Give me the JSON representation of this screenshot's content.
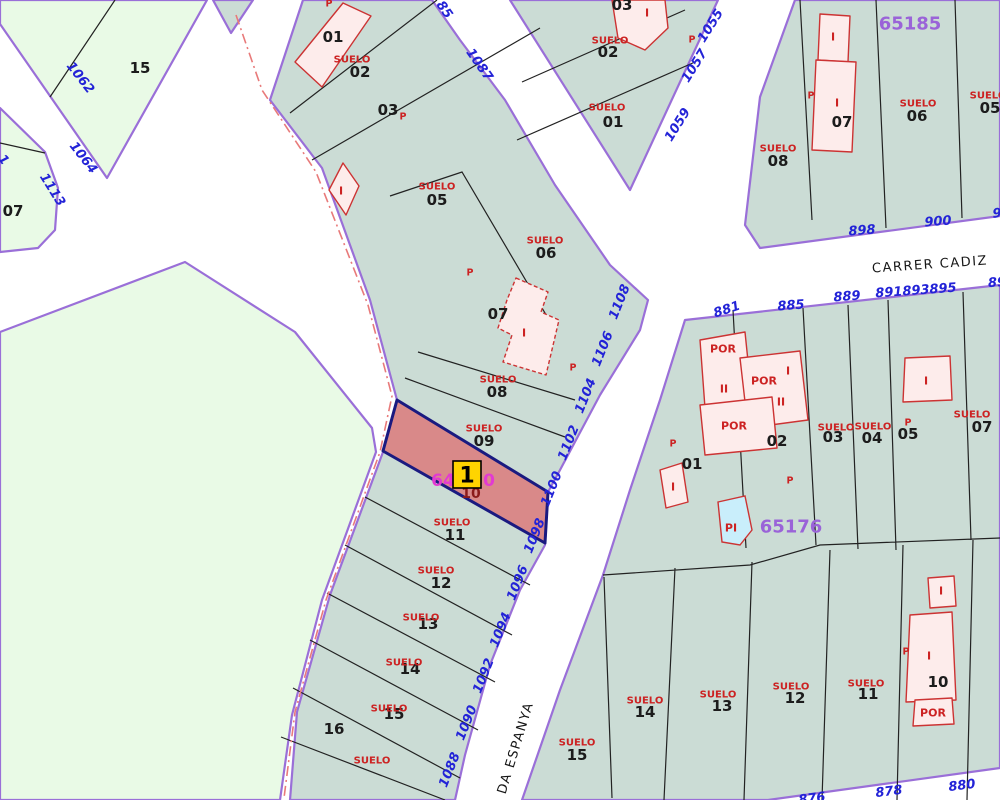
{
  "colors": {
    "parcel_teal": "#cbdcd5",
    "zone_green": "#e9fae6",
    "road_white": "#ffffff",
    "boundary_purple": "#9a6fd8",
    "parcel_line_black": "#222222",
    "building_fill": "#fdeceb",
    "building_stroke": "#cc3333",
    "highlight_fill": "#d98989",
    "highlight_border": "#1a1a80",
    "marker_fill": "#ffd400",
    "marker_border": "#000000",
    "label_blue": "#2323d7",
    "label_purple": "#9a63d8",
    "label_red": "#cc2222",
    "label_magenta": "#e23ad2",
    "label_black": "#1c1c1c",
    "label_maroon": "#8b1a1a",
    "dash_line": "#e87a7a",
    "pool_fill": "#c9eefb"
  },
  "marker": {
    "label": "1"
  },
  "zones": {
    "top_right": "65185",
    "bottom_right": "65176"
  },
  "streets": {
    "carrer_cadiz": "CARRER CADIZ",
    "avinguda_espanya": "DA ESPANYA"
  },
  "labels": [
    {
      "t": "1062",
      "x": 80,
      "y": 78,
      "r": 52,
      "c": "blue",
      "n": "road-number-1062"
    },
    {
      "t": "1064",
      "x": 83,
      "y": 158,
      "r": 52,
      "c": "blue",
      "n": "road-number-1064"
    },
    {
      "t": "1113",
      "x": 52,
      "y": 190,
      "r": 58,
      "c": "blue",
      "n": "road-number-1113"
    },
    {
      "t": "1",
      "x": 3,
      "y": 160,
      "r": 52,
      "c": "blue",
      "n": "road-number-partial-left"
    },
    {
      "t": "85",
      "x": 444,
      "y": 10,
      "r": 55,
      "c": "blue",
      "n": "road-number-partial-1085"
    },
    {
      "t": "1087",
      "x": 479,
      "y": 65,
      "r": 55,
      "c": "blue",
      "n": "road-number-1087"
    },
    {
      "t": "1059",
      "x": 678,
      "y": 125,
      "r": -58,
      "c": "blue",
      "n": "road-number-1059"
    },
    {
      "t": "1057",
      "x": 695,
      "y": 66,
      "r": -58,
      "c": "blue",
      "n": "road-number-1057"
    },
    {
      "t": "1055",
      "x": 711,
      "y": 26,
      "r": -58,
      "c": "blue",
      "n": "road-number-1055"
    },
    {
      "t": "898",
      "x": 862,
      "y": 231,
      "r": -4,
      "c": "blue",
      "n": "road-number-898"
    },
    {
      "t": "900",
      "x": 938,
      "y": 222,
      "r": -4,
      "c": "blue",
      "n": "road-number-900"
    },
    {
      "t": "9",
      "x": 997,
      "y": 214,
      "r": -4,
      "c": "blue",
      "n": "road-number-partial-right-top"
    },
    {
      "t": "885",
      "x": 791,
      "y": 306,
      "r": -4,
      "c": "blue",
      "n": "road-number-885"
    },
    {
      "t": "889",
      "x": 847,
      "y": 297,
      "r": -4,
      "c": "blue",
      "n": "road-number-889"
    },
    {
      "t": "891893895",
      "x": 916,
      "y": 291,
      "r": -4,
      "c": "blue",
      "n": "road-number-891-893-895"
    },
    {
      "t": "89",
      "x": 997,
      "y": 283,
      "r": -4,
      "c": "blue",
      "n": "road-number-partial-right"
    },
    {
      "t": "881",
      "x": 727,
      "y": 310,
      "r": -18,
      "c": "blue",
      "n": "road-number-881"
    },
    {
      "t": "1108",
      "x": 620,
      "y": 302,
      "r": -68,
      "c": "blue",
      "n": "road-number-1108"
    },
    {
      "t": "1106",
      "x": 603,
      "y": 349,
      "r": -68,
      "c": "blue",
      "n": "road-number-1106"
    },
    {
      "t": "1104",
      "x": 586,
      "y": 396,
      "r": -68,
      "c": "blue",
      "n": "road-number-1104"
    },
    {
      "t": "1102",
      "x": 569,
      "y": 443,
      "r": -68,
      "c": "blue",
      "n": "road-number-1102"
    },
    {
      "t": "1100",
      "x": 552,
      "y": 489,
      "r": -68,
      "c": "blue",
      "n": "road-number-1100"
    },
    {
      "t": "1098",
      "x": 535,
      "y": 536,
      "r": -68,
      "c": "blue",
      "n": "road-number-1098"
    },
    {
      "t": "1096",
      "x": 518,
      "y": 583,
      "r": -68,
      "c": "blue",
      "n": "road-number-1096"
    },
    {
      "t": "1094",
      "x": 501,
      "y": 630,
      "r": -68,
      "c": "blue",
      "n": "road-number-1094"
    },
    {
      "t": "1092",
      "x": 484,
      "y": 676,
      "r": -68,
      "c": "blue",
      "n": "road-number-1092"
    },
    {
      "t": "1090",
      "x": 467,
      "y": 723,
      "r": -68,
      "c": "blue",
      "n": "road-number-1090"
    },
    {
      "t": "1088",
      "x": 450,
      "y": 770,
      "r": -68,
      "c": "blue",
      "n": "road-number-1088"
    },
    {
      "t": "878",
      "x": 889,
      "y": 792,
      "r": -7,
      "c": "blue",
      "n": "road-number-878"
    },
    {
      "t": "880",
      "x": 962,
      "y": 786,
      "r": -7,
      "c": "blue",
      "n": "road-number-880"
    },
    {
      "t": "876",
      "x": 812,
      "y": 799,
      "r": -7,
      "c": "blue",
      "n": "road-number-partial-876"
    },
    {
      "t": "65185",
      "x": 910,
      "y": 24,
      "r": 0,
      "c": "purple",
      "n": "zone-number-65185"
    },
    {
      "t": "65176",
      "x": 791,
      "y": 527,
      "r": 0,
      "c": "purple",
      "n": "zone-number-65176"
    },
    {
      "t": "CARRER CADIZ",
      "x": 930,
      "y": 265,
      "r": -4,
      "c": "street",
      "n": "street-name-carrer-cadiz"
    },
    {
      "t": "DA ESPANYA",
      "x": 516,
      "y": 748,
      "r": -73,
      "c": "street",
      "n": "street-name-avinguda-espanya"
    },
    {
      "t": "15",
      "x": 140,
      "y": 68,
      "r": 0,
      "c": "black",
      "n": "parcel-number-15-topleft"
    },
    {
      "t": "07",
      "x": 13,
      "y": 211,
      "r": 0,
      "c": "black",
      "n": "parcel-number-07-topleft"
    },
    {
      "t": "01",
      "x": 333,
      "y": 37,
      "r": 0,
      "c": "black",
      "n": "parcel-number-01"
    },
    {
      "t": "02",
      "x": 360,
      "y": 72,
      "r": 0,
      "c": "black",
      "n": "parcel-number-02"
    },
    {
      "t": "03",
      "x": 388,
      "y": 110,
      "r": 0,
      "c": "black",
      "n": "parcel-number-03"
    },
    {
      "t": "05",
      "x": 437,
      "y": 200,
      "r": 0,
      "c": "black",
      "n": "parcel-number-05"
    },
    {
      "t": "06",
      "x": 546,
      "y": 253,
      "r": 0,
      "c": "black",
      "n": "parcel-number-06"
    },
    {
      "t": "07",
      "x": 498,
      "y": 314,
      "r": 0,
      "c": "black",
      "n": "parcel-number-07"
    },
    {
      "t": "08",
      "x": 497,
      "y": 392,
      "r": 0,
      "c": "black",
      "n": "parcel-number-08"
    },
    {
      "t": "09",
      "x": 484,
      "y": 441,
      "r": 0,
      "c": "black",
      "n": "parcel-number-09"
    },
    {
      "t": "11",
      "x": 455,
      "y": 535,
      "r": 0,
      "c": "black",
      "n": "parcel-number-11"
    },
    {
      "t": "12",
      "x": 441,
      "y": 583,
      "r": 0,
      "c": "black",
      "n": "parcel-number-12"
    },
    {
      "t": "13",
      "x": 428,
      "y": 624,
      "r": 0,
      "c": "black",
      "n": "parcel-number-13"
    },
    {
      "t": "14",
      "x": 410,
      "y": 669,
      "r": 0,
      "c": "black",
      "n": "parcel-number-14"
    },
    {
      "t": "15",
      "x": 394,
      "y": 714,
      "r": 0,
      "c": "black",
      "n": "parcel-number-15"
    },
    {
      "t": "16",
      "x": 334,
      "y": 729,
      "r": 0,
      "c": "black",
      "n": "parcel-number-16"
    },
    {
      "t": "02",
      "x": 608,
      "y": 52,
      "r": 0,
      "c": "black",
      "n": "parcel-number-02-center"
    },
    {
      "t": "01",
      "x": 613,
      "y": 122,
      "r": 0,
      "c": "black",
      "n": "parcel-number-01-center"
    },
    {
      "t": "03",
      "x": 622,
      "y": 5,
      "r": 0,
      "c": "black",
      "n": "parcel-number-03-center"
    },
    {
      "t": "07",
      "x": 842,
      "y": 122,
      "r": 0,
      "c": "black",
      "n": "parcel-number-07-65185"
    },
    {
      "t": "06",
      "x": 917,
      "y": 116,
      "r": 0,
      "c": "black",
      "n": "parcel-number-06-65185"
    },
    {
      "t": "05",
      "x": 990,
      "y": 108,
      "r": 0,
      "c": "black",
      "n": "parcel-number-05-65185"
    },
    {
      "t": "08",
      "x": 778,
      "y": 161,
      "r": 0,
      "c": "black",
      "n": "parcel-number-08-65185"
    },
    {
      "t": "01",
      "x": 692,
      "y": 464,
      "r": 0,
      "c": "black",
      "n": "parcel-number-01-65176"
    },
    {
      "t": "02",
      "x": 777,
      "y": 441,
      "r": 0,
      "c": "black",
      "n": "parcel-number-02-65176"
    },
    {
      "t": "03",
      "x": 833,
      "y": 437,
      "r": 0,
      "c": "black",
      "n": "parcel-number-03-65176"
    },
    {
      "t": "04",
      "x": 872,
      "y": 438,
      "r": 0,
      "c": "black",
      "n": "parcel-number-04-65176"
    },
    {
      "t": "05",
      "x": 908,
      "y": 434,
      "r": 0,
      "c": "black",
      "n": "parcel-number-05-65176"
    },
    {
      "t": "07",
      "x": 982,
      "y": 427,
      "r": 0,
      "c": "black",
      "n": "parcel-number-07-65176"
    },
    {
      "t": "15",
      "x": 577,
      "y": 755,
      "r": 0,
      "c": "black",
      "n": "parcel-number-15-65176"
    },
    {
      "t": "14",
      "x": 645,
      "y": 712,
      "r": 0,
      "c": "black",
      "n": "parcel-number-14-65176"
    },
    {
      "t": "13",
      "x": 722,
      "y": 706,
      "r": 0,
      "c": "black",
      "n": "parcel-number-13-65176"
    },
    {
      "t": "12",
      "x": 795,
      "y": 698,
      "r": 0,
      "c": "black",
      "n": "parcel-number-12-65176"
    },
    {
      "t": "11",
      "x": 868,
      "y": 694,
      "r": 0,
      "c": "black",
      "n": "parcel-number-11-65176"
    },
    {
      "t": "10",
      "x": 938,
      "y": 682,
      "r": 0,
      "c": "black",
      "n": "parcel-number-10-65176"
    },
    {
      "t": "10",
      "x": 471,
      "y": 494,
      "r": 0,
      "c": "maroon",
      "n": "parcel-number-10-highlight"
    },
    {
      "t": "SUELO",
      "x": 352,
      "y": 60,
      "r": 0,
      "c": "red",
      "n": "suelo-label"
    },
    {
      "t": "SUELO",
      "x": 437,
      "y": 187,
      "r": 0,
      "c": "red",
      "n": "suelo-label"
    },
    {
      "t": "SUELO",
      "x": 545,
      "y": 241,
      "r": 0,
      "c": "red",
      "n": "suelo-label"
    },
    {
      "t": "SUELO",
      "x": 498,
      "y": 380,
      "r": 0,
      "c": "red",
      "n": "suelo-label"
    },
    {
      "t": "SUELO",
      "x": 484,
      "y": 429,
      "r": 0,
      "c": "red",
      "n": "suelo-label"
    },
    {
      "t": "SUELO",
      "x": 452,
      "y": 523,
      "r": 0,
      "c": "red",
      "n": "suelo-label"
    },
    {
      "t": "SUELO",
      "x": 436,
      "y": 571,
      "r": 0,
      "c": "red",
      "n": "suelo-label"
    },
    {
      "t": "SUELO",
      "x": 421,
      "y": 618,
      "r": 0,
      "c": "red",
      "n": "suelo-label"
    },
    {
      "t": "SUELO",
      "x": 404,
      "y": 663,
      "r": 0,
      "c": "red",
      "n": "suelo-label"
    },
    {
      "t": "SUELO",
      "x": 389,
      "y": 709,
      "r": 0,
      "c": "red",
      "n": "suelo-label"
    },
    {
      "t": "SUELO",
      "x": 372,
      "y": 761,
      "r": 0,
      "c": "red",
      "n": "suelo-label"
    },
    {
      "t": "SUELO",
      "x": 610,
      "y": 41,
      "r": 0,
      "c": "red",
      "n": "suelo-label"
    },
    {
      "t": "SUELO",
      "x": 607,
      "y": 108,
      "r": 0,
      "c": "red",
      "n": "suelo-label"
    },
    {
      "t": "SUELO",
      "x": 778,
      "y": 149,
      "r": 0,
      "c": "red",
      "n": "suelo-label"
    },
    {
      "t": "SUELO",
      "x": 918,
      "y": 104,
      "r": 0,
      "c": "red",
      "n": "suelo-label"
    },
    {
      "t": "SUELO",
      "x": 988,
      "y": 96,
      "r": 0,
      "c": "red",
      "n": "suelo-label"
    },
    {
      "t": "SUELO",
      "x": 836,
      "y": 428,
      "r": 0,
      "c": "red",
      "n": "suelo-label"
    },
    {
      "t": "SUELO",
      "x": 873,
      "y": 427,
      "r": 0,
      "c": "red",
      "n": "suelo-label"
    },
    {
      "t": "SUELO",
      "x": 972,
      "y": 415,
      "r": 0,
      "c": "red",
      "n": "suelo-label"
    },
    {
      "t": "SUELO",
      "x": 577,
      "y": 743,
      "r": 0,
      "c": "red",
      "n": "suelo-label"
    },
    {
      "t": "SUELO",
      "x": 645,
      "y": 701,
      "r": 0,
      "c": "red",
      "n": "suelo-label"
    },
    {
      "t": "SUELO",
      "x": 718,
      "y": 695,
      "r": 0,
      "c": "red",
      "n": "suelo-label"
    },
    {
      "t": "SUELO",
      "x": 791,
      "y": 687,
      "r": 0,
      "c": "red",
      "n": "suelo-label"
    },
    {
      "t": "SUELO",
      "x": 866,
      "y": 684,
      "r": 0,
      "c": "red",
      "n": "suelo-label"
    },
    {
      "t": "P",
      "x": 329,
      "y": 4,
      "r": 0,
      "c": "p",
      "n": "use-code-p"
    },
    {
      "t": "P",
      "x": 403,
      "y": 117,
      "r": 0,
      "c": "p",
      "n": "use-code-p"
    },
    {
      "t": "P",
      "x": 470,
      "y": 273,
      "r": 0,
      "c": "p",
      "n": "use-code-p"
    },
    {
      "t": "P",
      "x": 573,
      "y": 368,
      "r": 0,
      "c": "p",
      "n": "use-code-p"
    },
    {
      "t": "P",
      "x": 692,
      "y": 40,
      "r": 0,
      "c": "p",
      "n": "use-code-p"
    },
    {
      "t": "P",
      "x": 811,
      "y": 96,
      "r": 0,
      "c": "p",
      "n": "use-code-p"
    },
    {
      "t": "P",
      "x": 673,
      "y": 444,
      "r": 0,
      "c": "p",
      "n": "use-code-p"
    },
    {
      "t": "P",
      "x": 790,
      "y": 481,
      "r": 0,
      "c": "p",
      "n": "use-code-p"
    },
    {
      "t": "P",
      "x": 908,
      "y": 423,
      "r": 0,
      "c": "p",
      "n": "use-code-p"
    },
    {
      "t": "P",
      "x": 906,
      "y": 652,
      "r": 0,
      "c": "p",
      "n": "use-code-p"
    },
    {
      "t": "I",
      "x": 341,
      "y": 191,
      "r": 0,
      "c": "bldg",
      "n": "building-code-i"
    },
    {
      "t": "I",
      "x": 524,
      "y": 333,
      "r": 0,
      "c": "bldg",
      "n": "building-code-i"
    },
    {
      "t": "I",
      "x": 647,
      "y": 13,
      "r": 0,
      "c": "bldg",
      "n": "building-code-i"
    },
    {
      "t": "I",
      "x": 833,
      "y": 37,
      "r": 0,
      "c": "bldg",
      "n": "building-code-i"
    },
    {
      "t": "I",
      "x": 837,
      "y": 103,
      "r": 0,
      "c": "bldg",
      "n": "building-code-i"
    },
    {
      "t": "POR",
      "x": 723,
      "y": 349,
      "r": 0,
      "c": "bldg",
      "n": "building-code-por"
    },
    {
      "t": "II",
      "x": 724,
      "y": 389,
      "r": 0,
      "c": "bldg",
      "n": "building-code-ii"
    },
    {
      "t": "POR",
      "x": 764,
      "y": 381,
      "r": 0,
      "c": "bldg",
      "n": "building-code-por"
    },
    {
      "t": "I",
      "x": 788,
      "y": 371,
      "r": 0,
      "c": "bldg",
      "n": "building-code-i"
    },
    {
      "t": "II",
      "x": 781,
      "y": 402,
      "r": 0,
      "c": "bldg",
      "n": "building-code-ii"
    },
    {
      "t": "POR",
      "x": 734,
      "y": 426,
      "r": 0,
      "c": "bldg",
      "n": "building-code-por"
    },
    {
      "t": "I",
      "x": 673,
      "y": 487,
      "r": 0,
      "c": "bldg",
      "n": "building-code-i"
    },
    {
      "t": "PI",
      "x": 731,
      "y": 528,
      "r": 0,
      "c": "bldg",
      "n": "building-code-pi"
    },
    {
      "t": "I",
      "x": 926,
      "y": 381,
      "r": 0,
      "c": "bldg",
      "n": "building-code-i"
    },
    {
      "t": "I",
      "x": 941,
      "y": 591,
      "r": 0,
      "c": "bldg",
      "n": "building-code-i"
    },
    {
      "t": "I",
      "x": 929,
      "y": 656,
      "r": 0,
      "c": "bldg",
      "n": "building-code-i"
    },
    {
      "t": "POR",
      "x": 933,
      "y": 713,
      "r": 0,
      "c": "bldg",
      "n": "building-code-por"
    },
    {
      "t": "64",
      "x": 443,
      "y": 481,
      "r": 0,
      "c": "magenta",
      "n": "reference-number-partial"
    },
    {
      "t": "0",
      "x": 489,
      "y": 481,
      "r": 0,
      "c": "magenta",
      "n": "reference-number-partial"
    }
  ]
}
